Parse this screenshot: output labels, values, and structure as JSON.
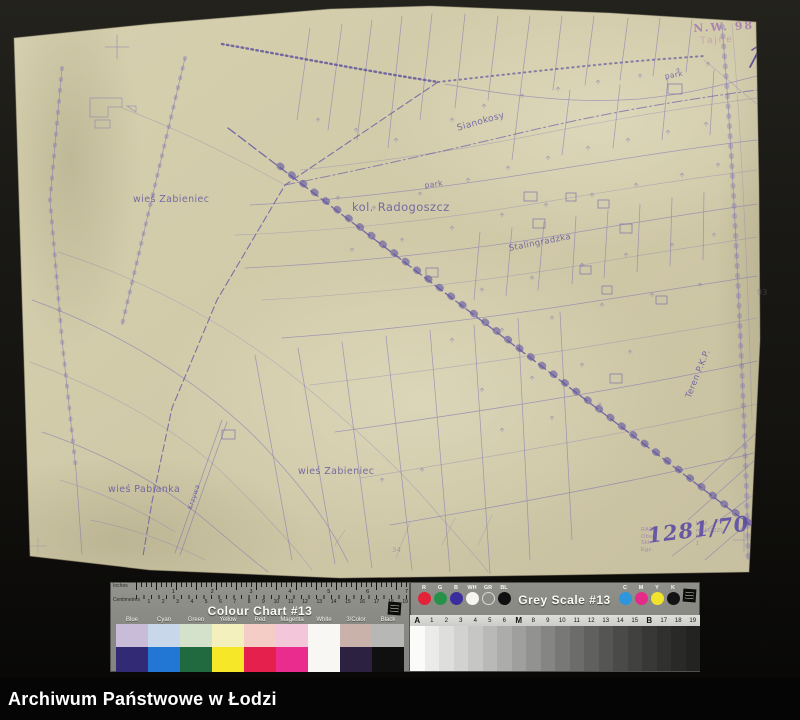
{
  "colors": {
    "paper": "#d1caa9",
    "ink": "#7b70b2",
    "ink_dark": "#5f54a2",
    "scan_bg": "#14130f"
  },
  "map": {
    "labels": [
      {
        "text": "wieś Żabieniec",
        "x": 133,
        "y": 194,
        "size": 9.5,
        "rot": 0
      },
      {
        "text": "kol. Radogoszcz",
        "x": 352,
        "y": 200,
        "size": 11.5,
        "rot": 0
      },
      {
        "text": "Sianokosy",
        "x": 456,
        "y": 124,
        "size": 9,
        "rot": -16
      },
      {
        "text": "park",
        "x": 424,
        "y": 181,
        "size": 7.5,
        "rot": -8
      },
      {
        "text": "park",
        "x": 664,
        "y": 72,
        "size": 7.5,
        "rot": -10
      },
      {
        "text": "Stalingradzka",
        "x": 508,
        "y": 244,
        "size": 8.5,
        "rot": -11
      },
      {
        "text": "wieś Żabieniec",
        "x": 298,
        "y": 466,
        "size": 9.5,
        "rot": 0
      },
      {
        "text": "wieś Pabianka",
        "x": 108,
        "y": 484,
        "size": 9.5,
        "rot": 0
      },
      {
        "text": "Teren P.K.P.",
        "x": 684,
        "y": 396,
        "size": 8.5,
        "rot": -68
      },
      {
        "text": "Krzywa",
        "x": 186,
        "y": 508,
        "size": 6.5,
        "rot": -72
      }
    ],
    "stamps": {
      "top_right": {
        "line1": "N.W. 98",
        "line2": "Tajne"
      },
      "bottom_right": {
        "left_lines": [
          "RADY",
          "Obw.",
          "Skł.",
          "Egz."
        ],
        "right_lines": [
          "U.M.",
          "m. ŁODZI",
          "Nr",
          "1"
        ],
        "handwritten": "1281/70"
      }
    },
    "pencil_marks": {
      "right": "93",
      "bottom": "34"
    }
  },
  "colour_chart": {
    "title": "Colour Chart #13",
    "ruler": {
      "inches_label": "Inches",
      "cm_label": "Centimetres",
      "inch_numbers": [
        "1",
        "2",
        "3",
        "4",
        "5",
        "6",
        "7"
      ],
      "cm_numbers": [
        "1",
        "2",
        "3",
        "4",
        "5",
        "6",
        "7",
        "8",
        "9",
        "10",
        "11",
        "12",
        "13",
        "14",
        "15",
        "16",
        "17",
        "18",
        "19"
      ]
    },
    "columns": [
      {
        "label": "Blue",
        "pastel": "#c9bcd8",
        "saturated": "#332a75"
      },
      {
        "label": "Cyan",
        "pastel": "#c8d8ea",
        "saturated": "#2277d4"
      },
      {
        "label": "Green",
        "pastel": "#d4e2cb",
        "saturated": "#21693f"
      },
      {
        "label": "Yellow",
        "pastel": "#f4f0bd",
        "saturated": "#f6e728"
      },
      {
        "label": "Red",
        "pastel": "#f3cdc6",
        "saturated": "#e6204c"
      },
      {
        "label": "Magenta",
        "pastel": "#f4c6da",
        "saturated": "#e92c8d"
      },
      {
        "label": "White",
        "pastel": "#f8f7f3",
        "saturated": "#f8f7f3"
      },
      {
        "label": "3/Color",
        "pastel": "#c9b2aa",
        "saturated": "#2c2140"
      },
      {
        "label": "Black",
        "pastel": "#b7b7b5",
        "saturated": "#101010"
      }
    ]
  },
  "grey_scale": {
    "title": "Grey Scale #13",
    "dots_left": [
      {
        "label": "R",
        "color": "#e32338"
      },
      {
        "label": "G",
        "color": "#27914a"
      },
      {
        "label": "B",
        "color": "#3a2d9d"
      },
      {
        "label": "WH",
        "color": "#f6f5f1"
      },
      {
        "label": "GR",
        "color": "transparent",
        "ring": "#d9d9d5"
      },
      {
        "label": "BL",
        "color": "#101010"
      }
    ],
    "dots_right": [
      {
        "label": "C",
        "color": "#2d96dd"
      },
      {
        "label": "M",
        "color": "#e62a87"
      },
      {
        "label": "Y",
        "color": "#f1e32b"
      },
      {
        "label": "K",
        "color": "#131313"
      }
    ],
    "step_labels": [
      "A",
      "1",
      "2",
      "3",
      "4",
      "5",
      "6",
      "M",
      "8",
      "9",
      "10",
      "11",
      "12",
      "13",
      "14",
      "15",
      "B",
      "17",
      "18",
      "19"
    ],
    "step_colors": [
      "#fbfbf9",
      "#ebebe9",
      "#dededc",
      "#d2d2d0",
      "#c6c6c4",
      "#b9b9b7",
      "#acacaa",
      "#9f9f9d",
      "#929290",
      "#858583",
      "#787876",
      "#6c6c6a",
      "#60605e",
      "#555553",
      "#4a4a48",
      "#414140",
      "#383837",
      "#30302f",
      "#292928",
      "#232322"
    ]
  },
  "archive_bar": {
    "title": "Archiwum Państwowe w Łodzi"
  }
}
